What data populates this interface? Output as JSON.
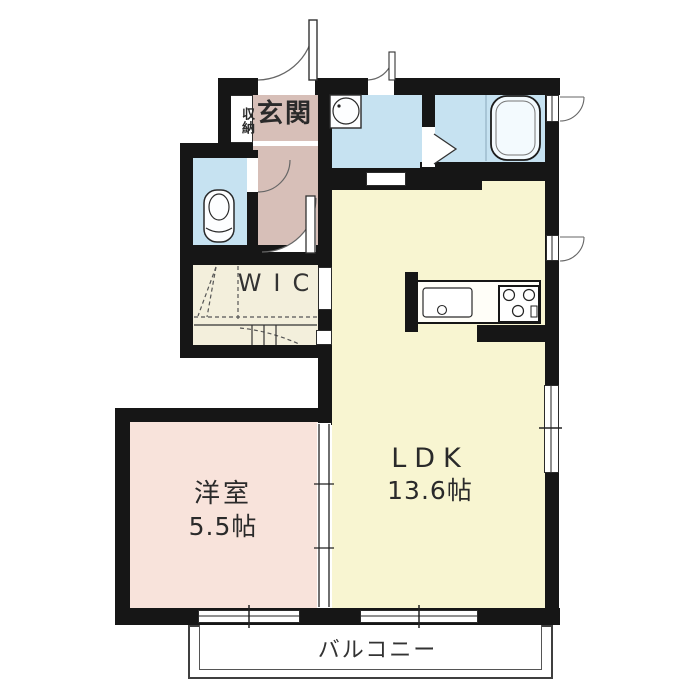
{
  "floorplan": {
    "type": "japanese-apartment-floor-plan",
    "wall_color": "#161616",
    "rooms": {
      "shuno": {
        "label": "収納",
        "color": "#ffffff"
      },
      "genkan": {
        "label": "玄関",
        "color": "#d7bfb8"
      },
      "toilet": {
        "color": "#c6e2f1",
        "fixture": "toilet-icon"
      },
      "washroom": {
        "color": "#c6e2f1",
        "fixture": "washbasin-icon"
      },
      "bathroom": {
        "color": "#c6e2f1",
        "fixture": "bathtub-icon"
      },
      "wic": {
        "label": "WIC",
        "color": "#f3efdc"
      },
      "ldk": {
        "label": "LDK",
        "size": "13.6帖",
        "color": "#f8f5d1",
        "fixtures": [
          "kitchen-sink-icon",
          "stove-icon"
        ]
      },
      "yoshitsu": {
        "label": "洋室",
        "size": "5.5帖",
        "color": "#f8e3db"
      },
      "balcony": {
        "label": "バルコニー",
        "color": "#ffffff"
      }
    },
    "doors": [
      "entrance-swing-door",
      "washroom-outer-door",
      "toilet-swing-door",
      "hall-swing-door",
      "bathroom-folding-door",
      "washroom-sliding-door",
      "yoshitsu-sliding-door"
    ],
    "windows": [
      "bathroom-window",
      "kitchen-window",
      "ldk-side-window",
      "yoshitsu-balcony-window",
      "ldk-balcony-window"
    ]
  }
}
